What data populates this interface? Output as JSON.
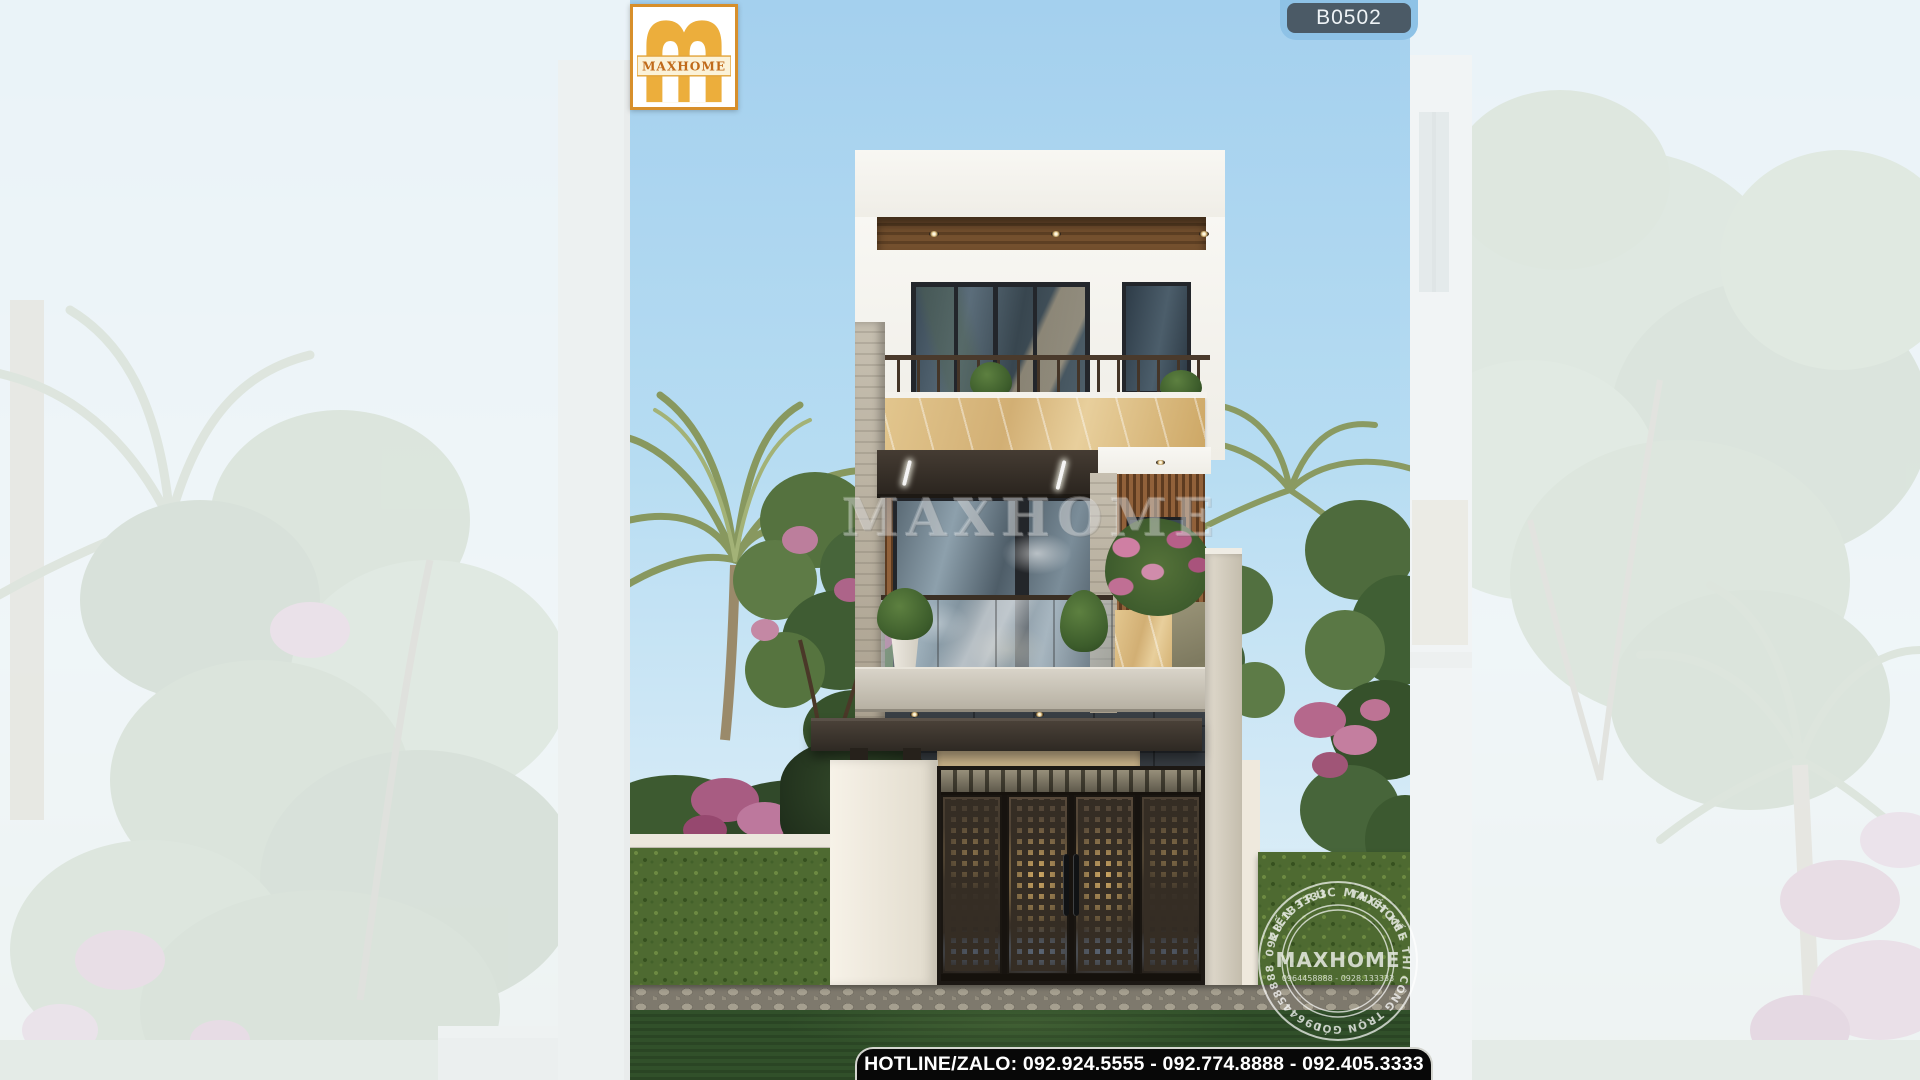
{
  "overlay": {
    "badge": "B0502",
    "logo_brand": "MAXHOME",
    "watermark": "MAXHOME",
    "hotline": "HOTLINE/ZALO: 092.924.5555 - 092.774.8888 - 092.405.3333"
  },
  "stamp": {
    "arc_top": "KIẾN TRÚC MAXHOME",
    "arc_service": "THIẾT KẾ - THI CÔNG TRỌN GÓI",
    "arc_phone_1": "0964458888",
    "arc_phone_2": "0928.133333",
    "center_brand": "MAXHOME",
    "center_phones": "0964458888 - 0928.133333"
  },
  "palette": {
    "sky": "#A7D2EE",
    "logo_gold": "#ECAE3C",
    "logo_border": "#D78F2B",
    "logo_text": "#C06A1A",
    "badge_bg": "#4B5A66",
    "badge_tab": "#8EC2E6",
    "hotline_bg": "#080808",
    "wood_soffit": "#6F4C2C",
    "wood_slats": "#8A5C36",
    "marble_beige": "#D8B77C",
    "travertine": "#B5AD9E",
    "slate": "#2C3136",
    "hedge_green": "#4E6A31",
    "lawn_green": "#31502A"
  }
}
